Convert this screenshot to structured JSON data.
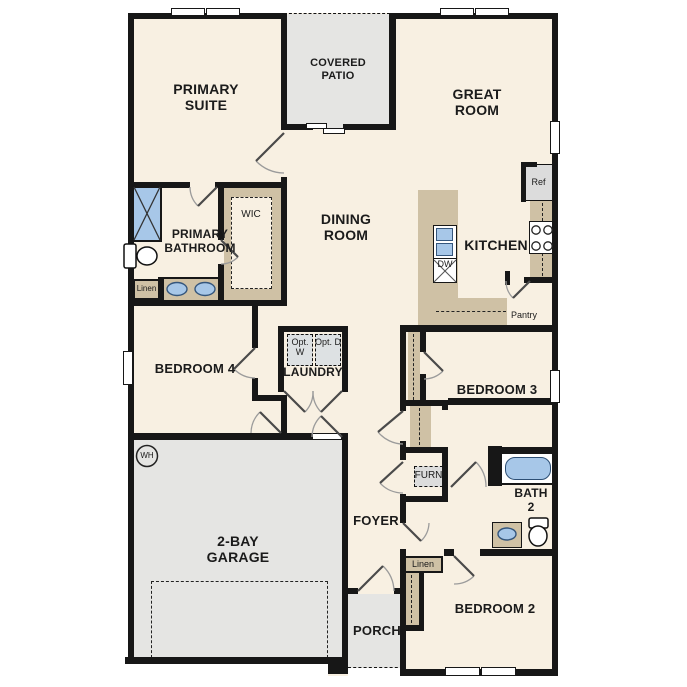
{
  "title": "Single-story floor plan",
  "colors": {
    "floor": "#f8f0e2",
    "outdoor": "#e5e5e3",
    "cabinet_tan": "#cfc1a5",
    "fixture_blue": "#a7c7e8",
    "wall": "#171717"
  },
  "labels": {
    "primary_suite": "PRIMARY SUITE",
    "covered_patio": "COVERED PATIO",
    "great_room": "GREAT ROOM",
    "dining_room": "DINING ROOM",
    "kitchen": "KITCHEN",
    "primary_bathroom": "PRIMARY BATHROOM",
    "wic": "WIC",
    "linen_bath": "Linen",
    "bedroom4": "BEDROOM 4",
    "laundry": "LAUNDRY",
    "opt_w": "Opt. W",
    "opt_d": "Opt. D",
    "garage": "2-BAY GARAGE",
    "wh": "WH",
    "foyer": "FOYER",
    "furn": "FURN",
    "bedroom3": "BEDROOM 3",
    "bath2": "BATH 2",
    "linen_hall": "Linen",
    "bedroom2": "BEDROOM 2",
    "porch": "PORCH",
    "ref": "Ref",
    "dw": "DW",
    "pantry": "Pantry"
  }
}
